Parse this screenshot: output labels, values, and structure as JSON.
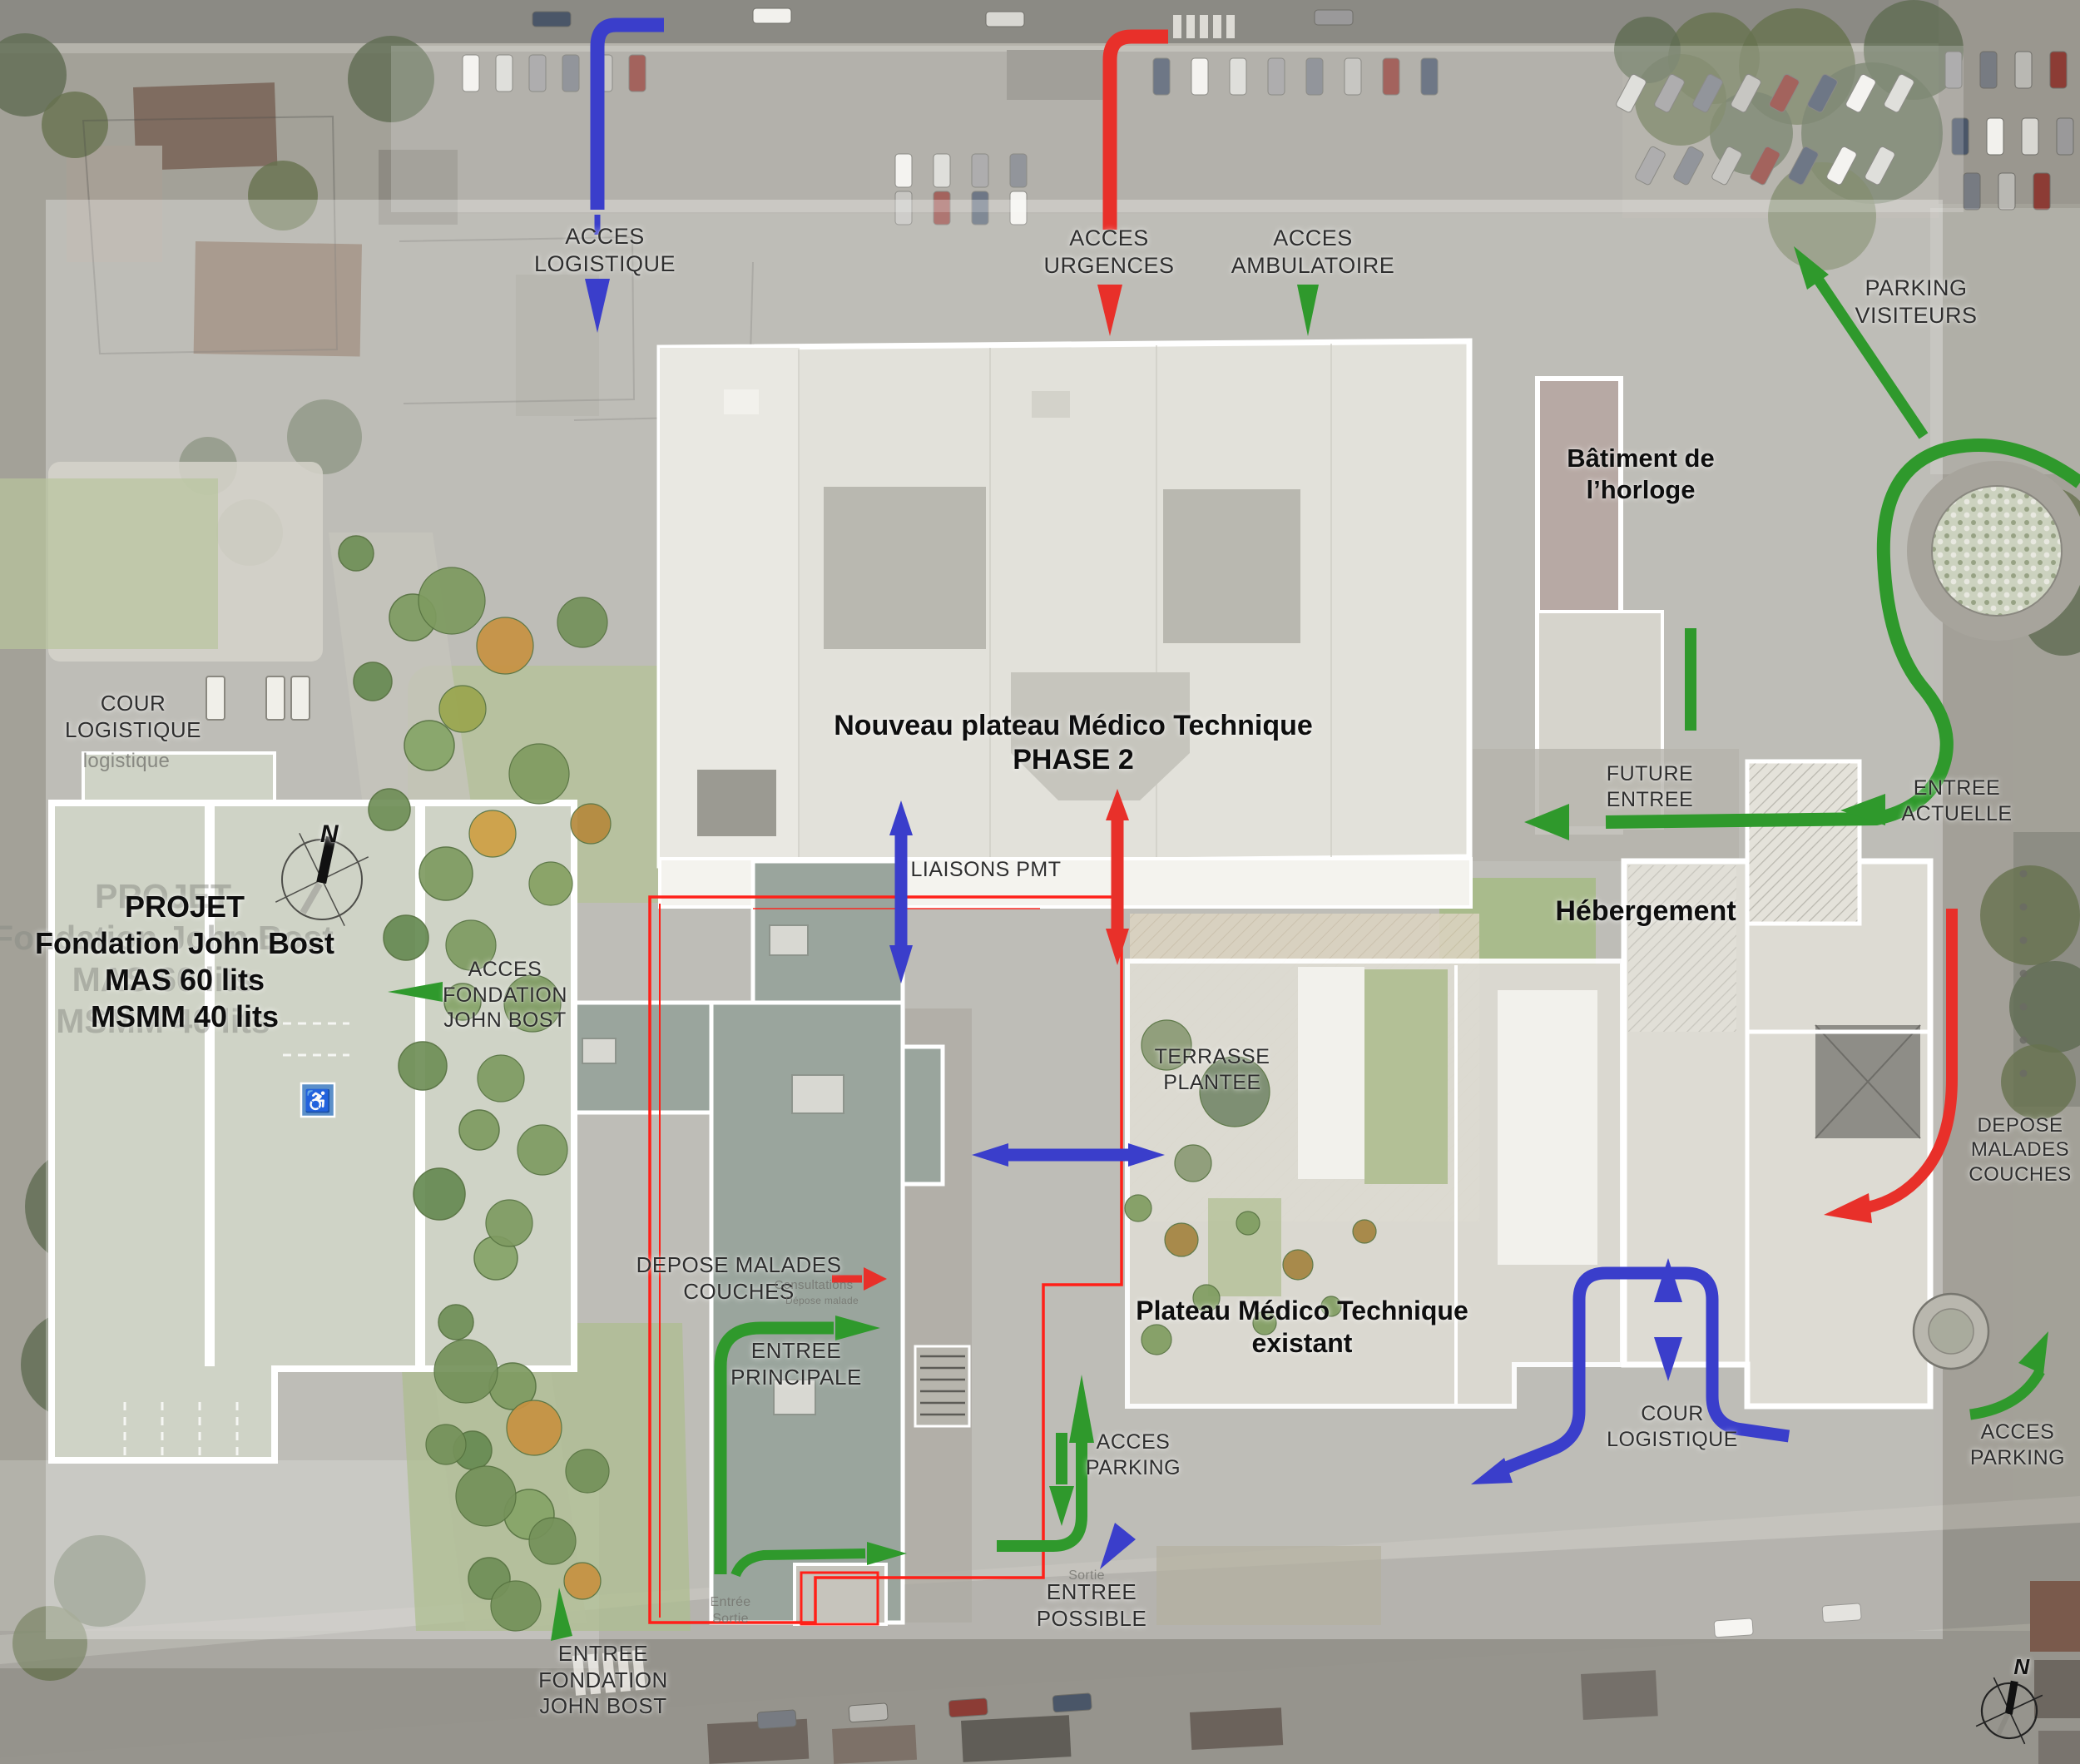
{
  "colors": {
    "route_blue": "#3a3ecb",
    "route_red": "#e8302a",
    "route_green": "#2f992c",
    "project_outline_red": "#ff2018"
  },
  "labels": {
    "acces_logistique": {
      "l1": "ACCES",
      "l2": "LOGISTIQUE"
    },
    "acces_urgences": {
      "l1": "ACCES",
      "l2": "URGENCES"
    },
    "acces_ambulatoire": {
      "l1": "ACCES",
      "l2": "AMBULATOIRE"
    },
    "parking_visiteurs": {
      "l1": "PARKING",
      "l2": "VISITEURS"
    },
    "batiment_horloge": {
      "l1": "Bâtiment de",
      "l2": "l’horloge"
    },
    "nouveau_plateau": {
      "l1": "Nouveau plateau Médico Technique",
      "l2": "PHASE 2"
    },
    "cour_logistique_left": {
      "l1": "COUR",
      "l2": "LOGISTIQUE"
    },
    "cour_logistique_ghost": {
      "l1": "cour",
      "l2": "logistique"
    },
    "projet": {
      "l1": "PROJET",
      "l2": "Fondation John Bost",
      "l3": "MAS 60 lits",
      "l4": "MSMM 40 lits"
    },
    "acces_fondation": {
      "l1": "ACCES",
      "l2": "FONDATION",
      "l3": "JOHN BOST"
    },
    "future_entree": {
      "l1": "FUTURE",
      "l2": "ENTREE"
    },
    "entree_actuelle": {
      "l1": "ENTREE",
      "l2": "ACTUELLE"
    },
    "hebergement": {
      "l1": "Hébergement"
    },
    "liaisons_pmt": {
      "l1": "LIAISONS PMT"
    },
    "terrasse_plantee": {
      "l1": "TERRASSE",
      "l2": "PLANTEE"
    },
    "depose_malades_center": {
      "l1": "DEPOSE MALADES",
      "l2": "COUCHES"
    },
    "consultations_faint": {
      "l1": "Consultations"
    },
    "depose_malade_faint": {
      "l1": "Dépose malade"
    },
    "entree_principale": {
      "l1": "ENTREE",
      "l2": "PRINCIPALE"
    },
    "plateau_existant": {
      "l1": "Plateau Médico Technique",
      "l2": "existant"
    },
    "acces_parking_center": {
      "l1": "ACCES",
      "l2": "PARKING"
    },
    "entree_possible": {
      "l1": "ENTREE",
      "l2": "POSSIBLE"
    },
    "sortie_faint": {
      "l1": "Sortie"
    },
    "entree_sortie_faint": {
      "l1": "Entrée",
      "l2": "Sortie"
    },
    "entree_fondation": {
      "l1": "ENTREE",
      "l2": "FONDATION",
      "l3": "JOHN BOST"
    },
    "cour_logistique_right": {
      "l1": "COUR",
      "l2": "LOGISTIQUE"
    },
    "acces_parking_right": {
      "l1": "ACCES",
      "l2": "PARKING"
    },
    "depose_malades_right": {
      "l1": "DEPOSE",
      "l2": "MALADES",
      "l3": "COUCHES"
    },
    "compass_n": {
      "text": "N"
    }
  }
}
